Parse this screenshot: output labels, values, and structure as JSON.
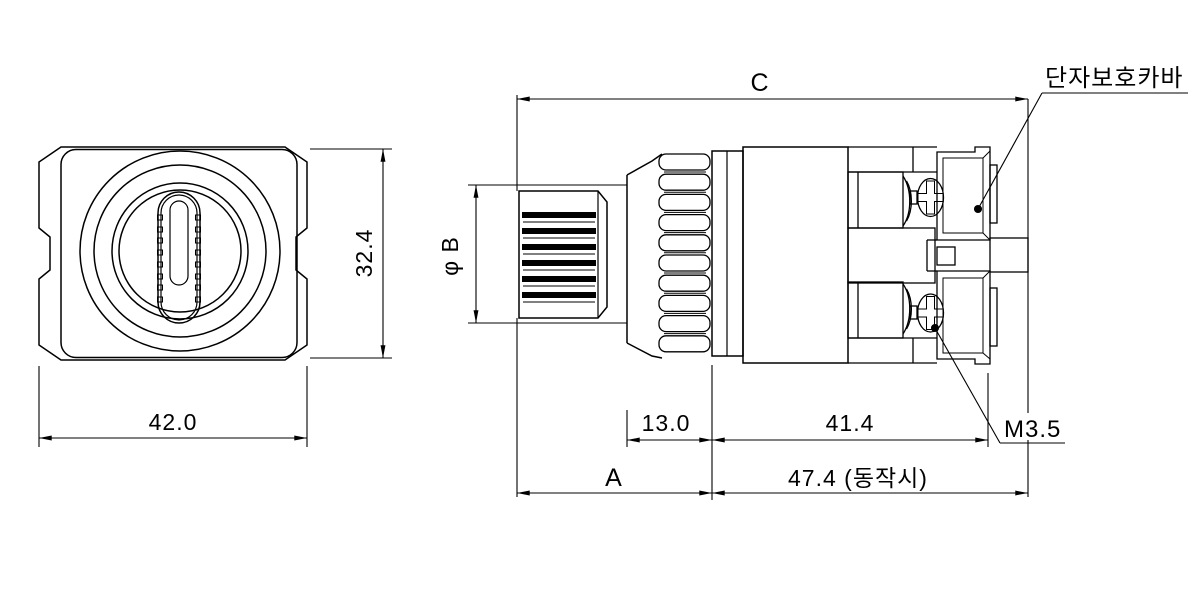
{
  "drawing": {
    "front_view": {
      "dim_width": "42.0",
      "dim_height": "32.4"
    },
    "side_view": {
      "dim_total_c": "C",
      "dim_knob_dia": "φ B",
      "dim_bezel": "13.0",
      "dim_body": "41.4",
      "dim_a": "A",
      "dim_operating": "47.4 (동작시)",
      "label_cover": "단자보호카바",
      "label_screw": "M3.5"
    },
    "colors": {
      "line_color": "#000000",
      "background_color": "#ffffff"
    }
  }
}
